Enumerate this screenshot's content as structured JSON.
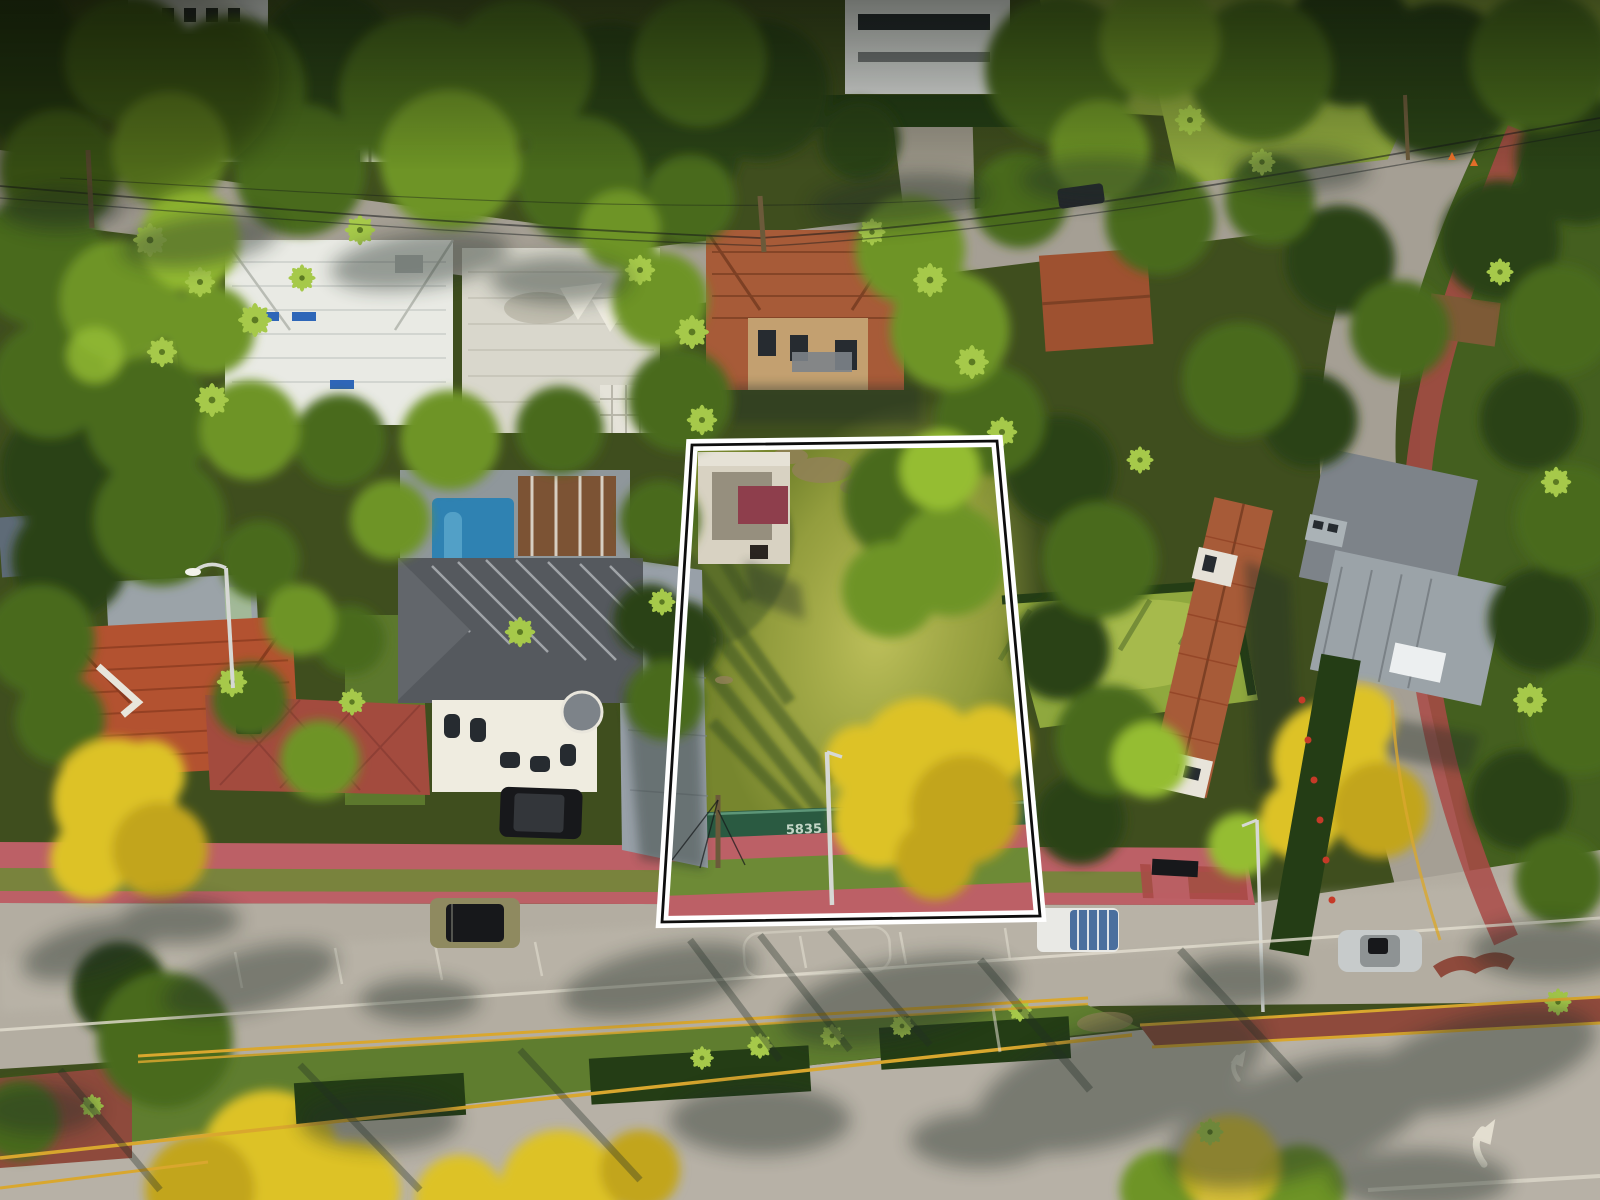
{
  "meta": {
    "title": "Aerial drone photo of tropical residential block with vacant lot outlined in white for sale",
    "width_px": 1600,
    "height_px": 1200
  },
  "scene": {
    "setting": "Top-down aerial of a Miami-Beach-style neighborhood: tiled-roof homes, royal palms, yellow tabebuia blooms, a main road with landscaped median at bottom, and a vacant grassy lot marked with a white property boundary",
    "property_outline": {
      "points": "692,445 997,441 1040,916 662,922",
      "outer_stroke": "#ffffff",
      "inner_stroke": "#0e0e0e"
    },
    "fence_banner_number": "5835",
    "vehicles": [
      {
        "name": "olive-suv-parked-on-road",
        "color": "#8f8a60"
      },
      {
        "name": "black-suv-in-driveway",
        "color": "#17181b"
      },
      {
        "name": "white-pickup-blue-bed-cover",
        "color": "#e9e9e5"
      },
      {
        "name": "silver-sedan",
        "color": "#c7cbcb"
      },
      {
        "name": "dark-car-upper-street",
        "color": "#23262b"
      }
    ],
    "road_markings": [
      "double-yellow-median-lines",
      "white-lane-line",
      "parking-bay-lines",
      "curved-turn-arrow-x2",
      "red-painted-median-strip"
    ],
    "landmarks": [
      "ruined-white-structure-with-maroon-roof-panel-inside-lot",
      "green-construction-fence-with-address",
      "pool-with-blue-water",
      "pergola",
      "yellow-blooming-trees",
      "pink-sidewalks",
      "white-perimeter-wall-upper-street",
      "power-lines",
      "street-lights",
      "guy-wired-utility-pole"
    ],
    "palette": {
      "canvas": "#3f4e1e",
      "roadMain": "#b3ada1",
      "roadTop": "#a59f94",
      "roadBottom": "#b7b1a6",
      "sidewalkPink": "#bc6066",
      "sidewalkRed": "#a94a46",
      "parkwayGreen": "#6d8a36",
      "medianGrass": "#5f7d2f",
      "hedgeDark": "#243d15",
      "canopyDark": "#2c4316",
      "canopyMid": "#486a1f",
      "canopyLight": "#6e9428",
      "canopyBright": "#95bd33",
      "palmGreen": "#a6c94a",
      "bloomYellow": "#ddc226",
      "bloomYellowDeep": "#c2a51e",
      "lawnSun": "#8fa83e",
      "lotGrass": "#77862e",
      "lotGrassSun": "#a8b04a",
      "lotShadow": "#3c521f",
      "roofWhiteA": "#e9eae4",
      "roofWhiteB": "#d9d7cc",
      "roofTerracotta": "#a75b38",
      "roofTerraDark": "#7d4024",
      "roofRedTile": "#b35230",
      "roofRedDark": "#8a3a1f",
      "roofGrayDark": "#55595e",
      "roofGrayMid": "#7d8389",
      "roofGrayLight": "#9ba3a8",
      "wallWhite": "#efece0",
      "wallTan": "#c3a070",
      "wallMint": "#a2b998",
      "ruinWall": "#d8d2c2",
      "ruinMaroon": "#8e3e4c",
      "poolBlue": "#2f82b2",
      "poolLight": "#5fa9cd",
      "pergolaBrown": "#7c5334",
      "paverGray": "#98a0a8",
      "brickRed": "#a34b3e",
      "fenceGreen": "#2a5a41",
      "fenceLight": "#5d9678",
      "laneWhite": "#e3ded0",
      "laneYellow": "#d9a72e",
      "redMedian": "#8e4a3c",
      "flowerRed": "#c63a28",
      "coneOrange": "#e8702a",
      "carBlack": "#17181b",
      "carOlive": "#8f8a60",
      "carWhite": "#e9e9e5",
      "carSilver": "#c7cbcb",
      "bedBlue": "#4a6f9e",
      "poleLight": "#d6d8d4",
      "poleWood": "#6b5a3a",
      "powerLine": "#15181a",
      "shadowTint": "#242e26",
      "buildingWhite": "#e9ebe9",
      "windowDark": "#262b30",
      "dirtTan": "#93815a",
      "awningBlue": "#2e66b8",
      "outlineWhite": "#ffffff",
      "outlineBlack": "#0e0e0e"
    }
  }
}
